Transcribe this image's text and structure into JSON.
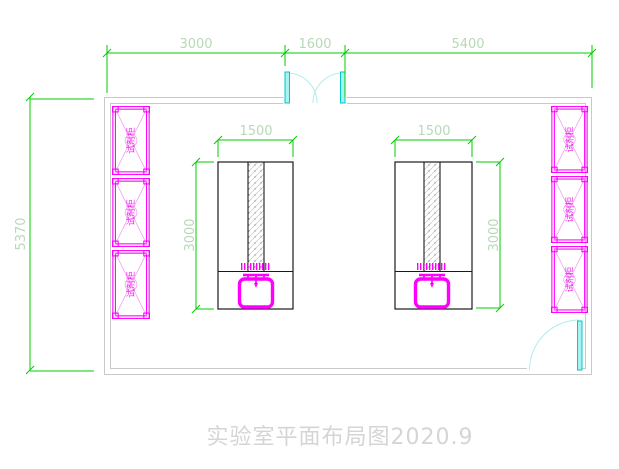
{
  "document": {
    "title": "实验室平面布局图2020.9"
  },
  "dimensions": {
    "top_segments": [
      "3000",
      "1600",
      "5400"
    ],
    "room_height": "5370",
    "bench_width": "1500",
    "bench_depth": "3000"
  },
  "cabinets": {
    "label": "试剂柜",
    "left_count": 3,
    "right_count": 3
  },
  "colors": {
    "dimension_line": "#00cc00",
    "dimension_text": "#b7d9b7",
    "wall": "#c9c9c9",
    "door_leaf": "#a8f2f2",
    "door_arc": "#b2ecec",
    "cabinet": "#ff00ff",
    "cabinet_detail": "#f2a0f2",
    "bench_outline": "#1a1a1a",
    "sink": "#ff00ff",
    "title_text": "#d5d5d5"
  }
}
